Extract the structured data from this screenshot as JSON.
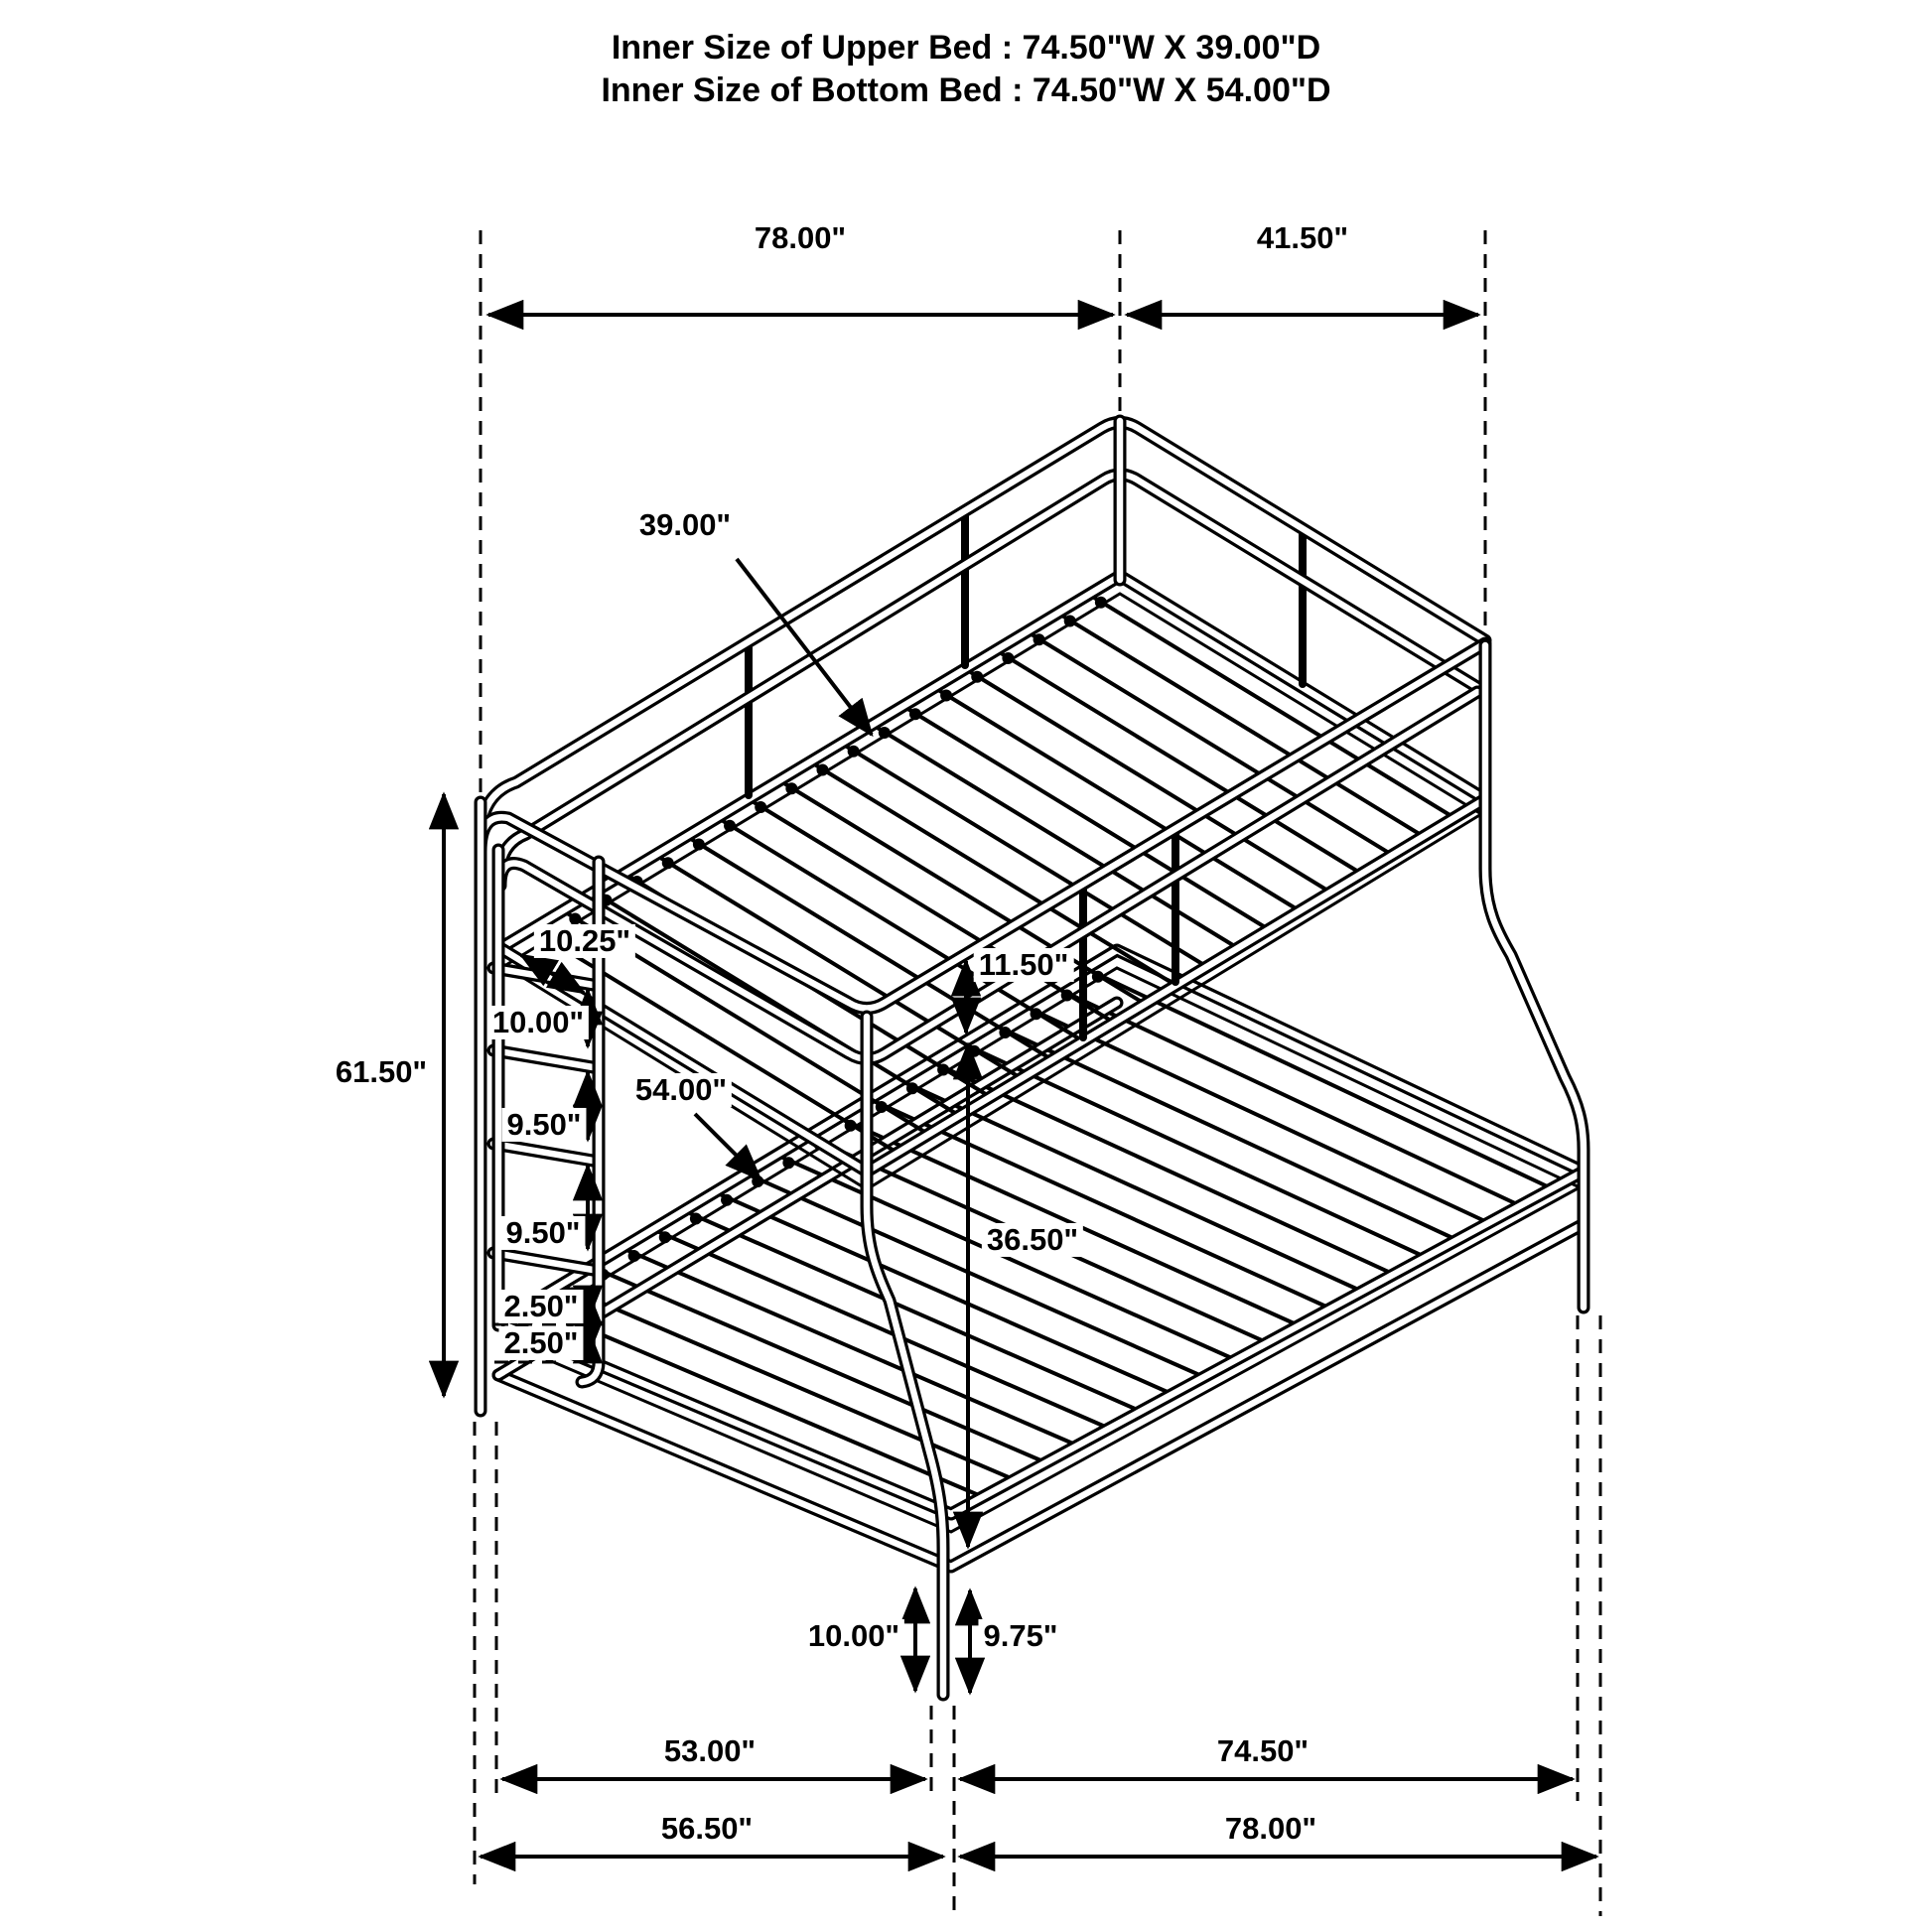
{
  "title": {
    "line1": "Inner Size of Upper Bed : 74.50\"W X 39.00\"D",
    "line2": "Inner Size of Bottom Bed : 74.50\"W X 54.00\"D"
  },
  "dims": {
    "overall_width": "78.00\"",
    "overall_depth": "41.50\"",
    "overall_height": "61.50\"",
    "upper_bed_depth": "39.00\"",
    "ladder_spacing_1": "10.25\"",
    "ladder_spacing_2": "10.00\"",
    "ladder_spacing_3": "9.50\"",
    "ladder_spacing_4": "9.50\"",
    "ladder_spacing_5": "2.50\"",
    "ladder_spacing_6": "2.50\"",
    "bunk_gap": "11.50\"",
    "lower_bed_depth": "54.00\"",
    "lower_rail_height": "36.50\"",
    "floor_clearance_front": "10.00\"",
    "floor_clearance_side": "9.75\"",
    "bottom_span_left": "53.00\"",
    "bottom_span_right": "74.50\"",
    "bottom_total_left": "56.50\"",
    "bottom_total_right": "78.00\""
  },
  "colors": {
    "line": "#000000",
    "background": "#ffffff"
  }
}
